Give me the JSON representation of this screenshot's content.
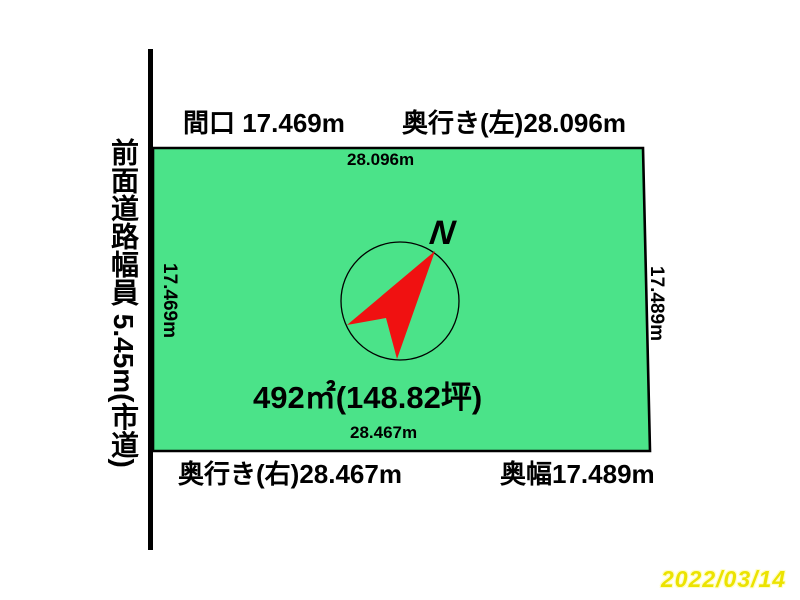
{
  "colors": {
    "plot_fill": "#4be389",
    "outline": "#000000",
    "needle_red": "#f01111",
    "date_yellow": "#ece300",
    "date_outline": "#fffdc8",
    "background": "#ffffff"
  },
  "road": {
    "label": "前面道路幅員 5.45m(市道)"
  },
  "dimensions": {
    "frontage": "間口 17.469m",
    "depth_left": "奥行き(左)28.096m",
    "depth_right": "奥行き(右)28.467m",
    "back_width": "奥幅17.489m"
  },
  "plot": {
    "top_edge": "28.096m",
    "left_edge": "17.469m",
    "right_edge": "17.489m",
    "bottom_edge": "28.467m",
    "area": "492㎡(148.82坪)"
  },
  "compass": {
    "letter": "N"
  },
  "date": {
    "value": "2022/03/14"
  }
}
